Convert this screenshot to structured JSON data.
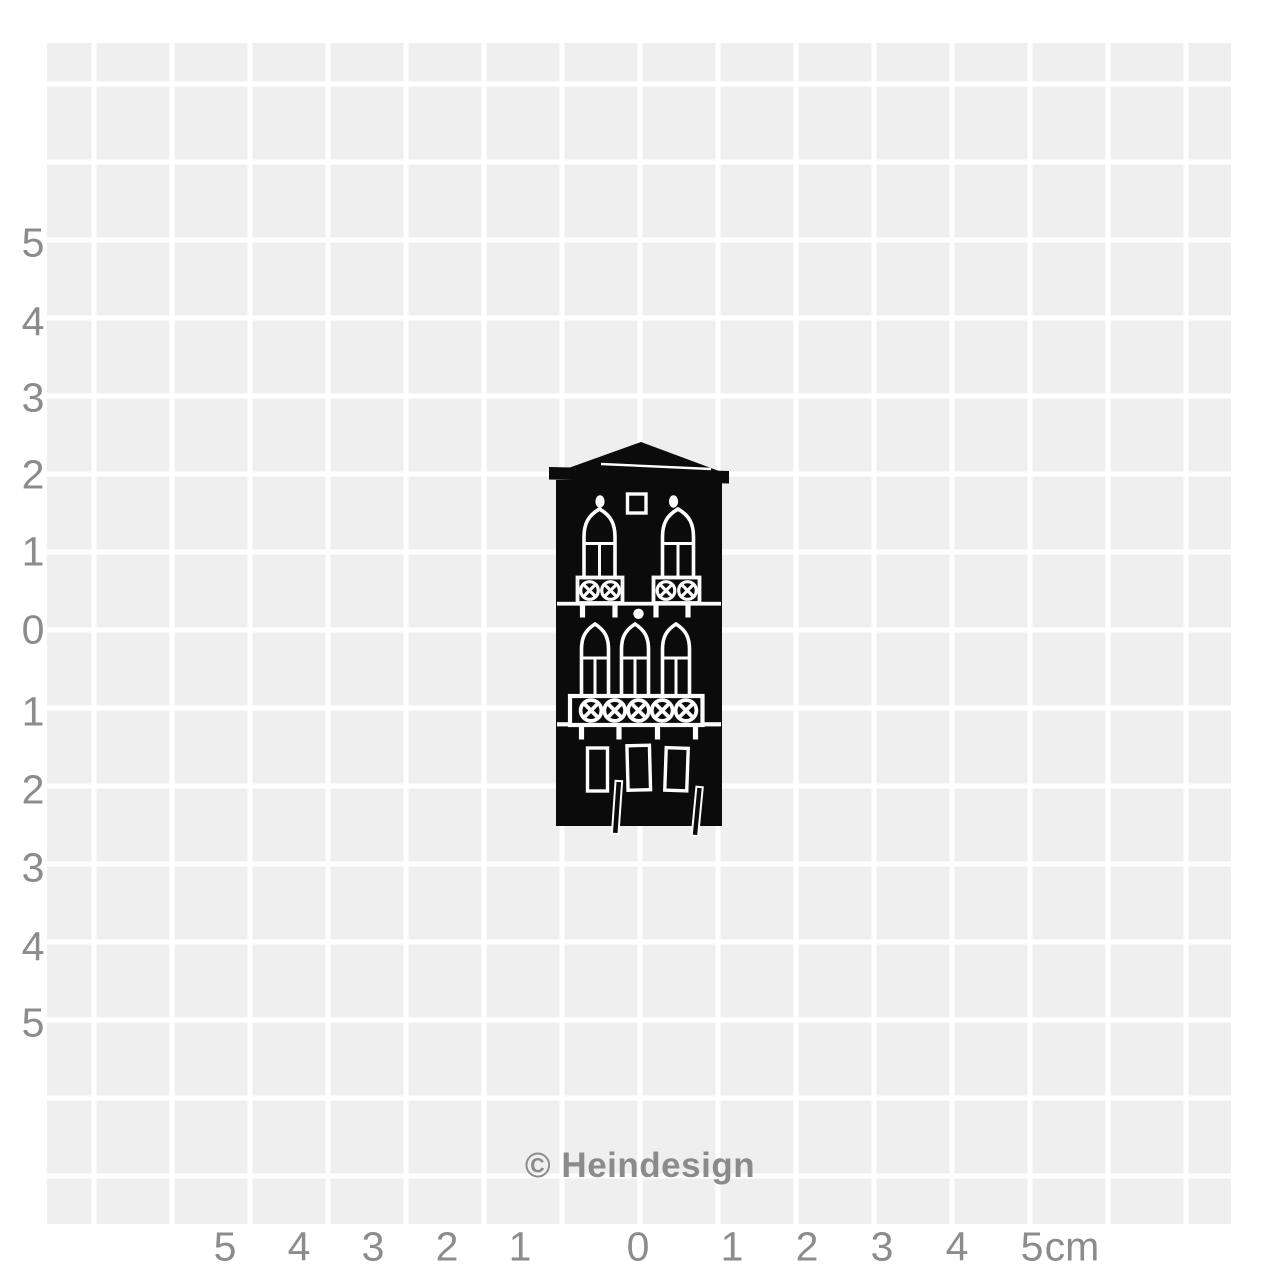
{
  "colors": {
    "page_bg": "#ffffff",
    "grid_bg": "#f0efef",
    "grid_line": "#ffffff",
    "axis_label": "#8c8c8c",
    "stamp_ink": "#0b0b0b",
    "stamp_carving": "#fdfdfd"
  },
  "ruler": {
    "unit": "cm",
    "left_axis_labels": [
      {
        "text": "5",
        "y": 243
      },
      {
        "text": "4",
        "y": 322
      },
      {
        "text": "3",
        "y": 398
      },
      {
        "text": "2",
        "y": 475
      },
      {
        "text": "1",
        "y": 552
      },
      {
        "text": "0",
        "y": 630
      },
      {
        "text": "1",
        "y": 712
      },
      {
        "text": "2",
        "y": 790
      },
      {
        "text": "3",
        "y": 868
      },
      {
        "text": "4",
        "y": 947
      },
      {
        "text": "5",
        "y": 1023
      }
    ],
    "bottom_axis_labels": [
      {
        "text": "5",
        "x": 225
      },
      {
        "text": "4",
        "x": 299
      },
      {
        "text": "3",
        "x": 373
      },
      {
        "text": "2",
        "x": 447
      },
      {
        "text": "1",
        "x": 520
      },
      {
        "text": "0",
        "x": 638
      },
      {
        "text": "1",
        "x": 732
      },
      {
        "text": "2",
        "x": 807
      },
      {
        "text": "3",
        "x": 882
      },
      {
        "text": "4",
        "x": 957
      },
      {
        "text": "5",
        "x": 1032
      },
      {
        "text": "cm",
        "x": 1072
      }
    ]
  },
  "watermark": {
    "text": "© Heindesign"
  },
  "stamp": {
    "motif": "venetian-palazzo-stamp"
  }
}
